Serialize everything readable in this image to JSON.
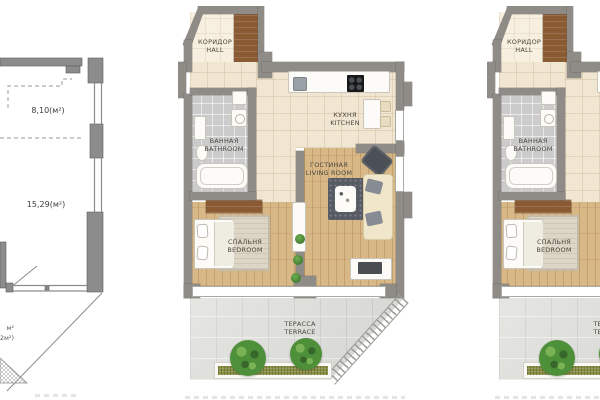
{
  "page": {
    "background": "#ffffff"
  },
  "left_plan": {
    "area_top_label": "8,10(м²)",
    "area_main_label": "15,29(м²)",
    "edge_partial_line1": "м²",
    "edge_partial_line2": "2м²)"
  },
  "floor_plan": {
    "rooms": {
      "hall": {
        "ru": "КОРИДОР",
        "en": "HALL"
      },
      "kitchen": {
        "ru": "КУХНЯ",
        "en": "KITCHEN"
      },
      "bathroom": {
        "ru": "ВАННАЯ",
        "en": "BATHROOM"
      },
      "living_room": {
        "ru": "ГОСТИНАЯ",
        "en": "LIVING ROOM"
      },
      "bedroom": {
        "ru": "СПАЛЬНЯ",
        "en": "BEDROOM"
      },
      "terrace": {
        "ru": "ТЕРАССА",
        "en": "TERRACE"
      }
    }
  },
  "colors": {
    "wall": "#8f8c87",
    "floor_beige": "#f1e6d1",
    "floor_beige_light": "#f7efdf",
    "floor_wood": "#d9b888",
    "floor_bath": "#cbcbcb",
    "floor_stone": "#dcddd8",
    "furniture_wood": "#8a5a33",
    "sofa_cream": "#f0e7cb",
    "dark_furniture": "#4b4f56",
    "plant_green": "#4e8f3a",
    "hedge_green": "#8a9144",
    "outline_gray": "#8c8c8c",
    "label_text": "#4a473f"
  }
}
